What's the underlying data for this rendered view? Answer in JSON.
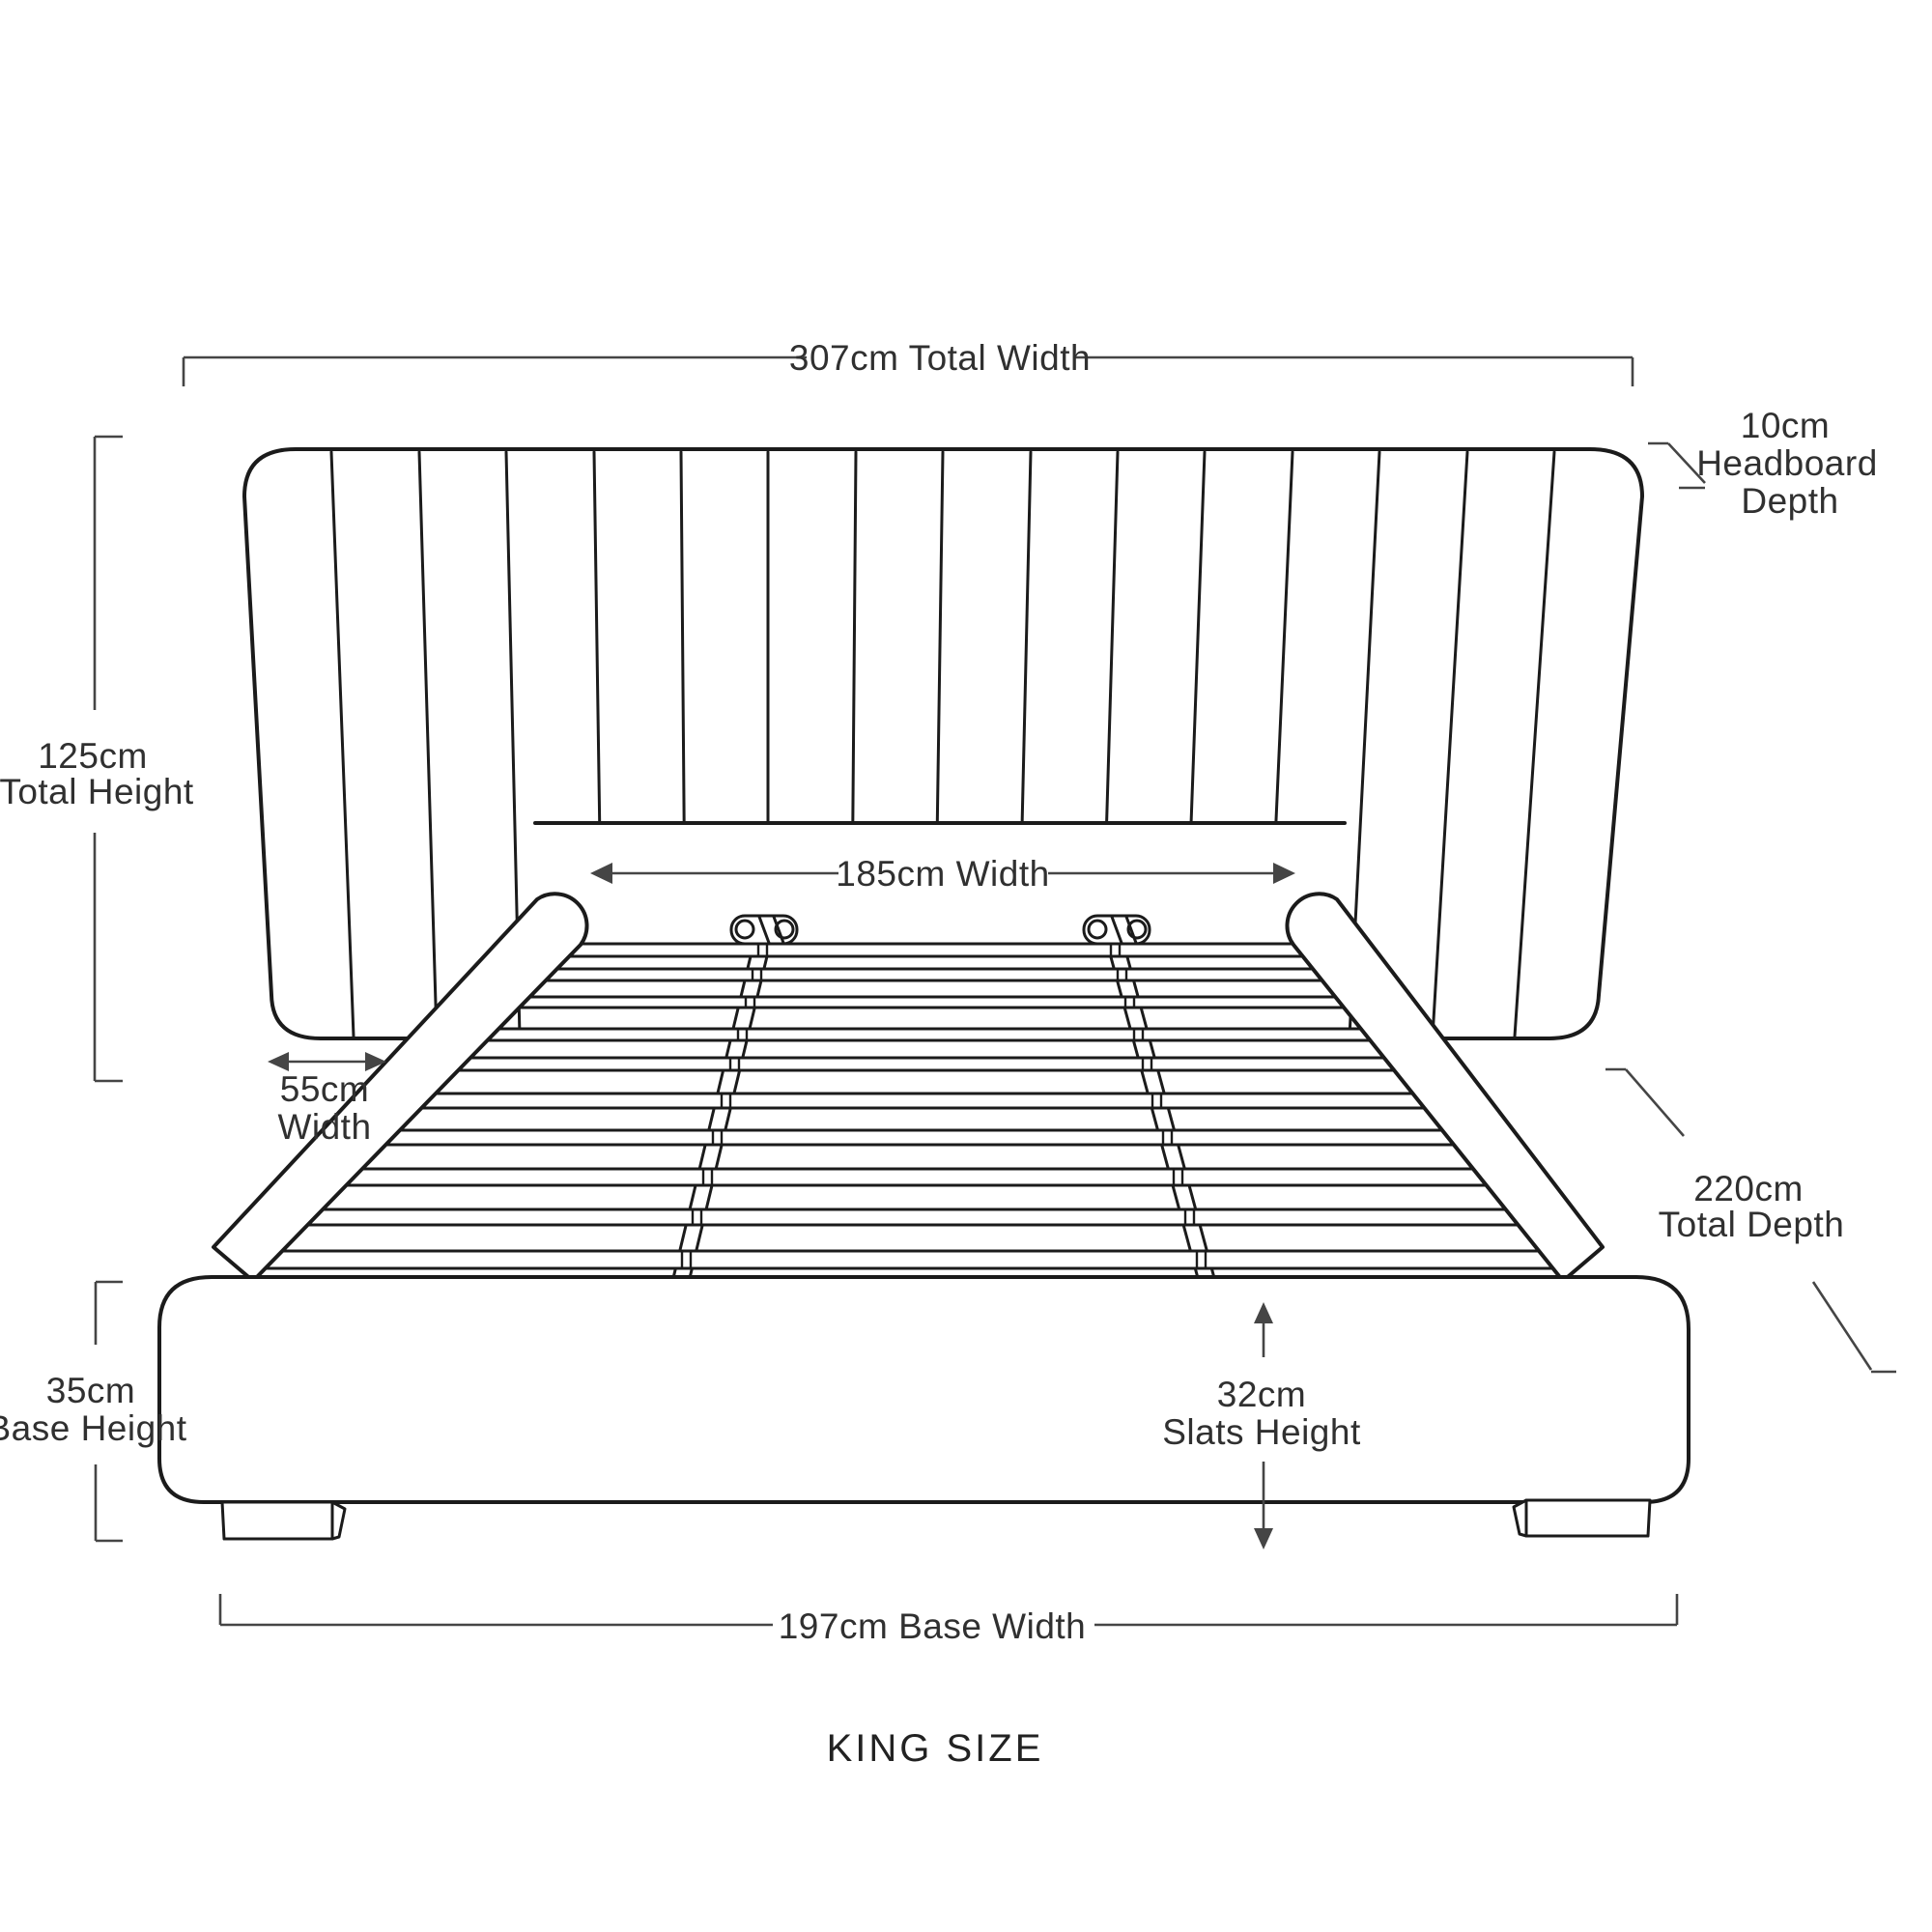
{
  "title": "KING SIZE",
  "colors": {
    "line": "#1b1b1b",
    "dimension": "#454545",
    "text": "#303030",
    "background": "#ffffff"
  },
  "dimensions": {
    "total_width": "307cm Total Width",
    "headboard_depth": [
      "10cm",
      "Headboard",
      "Depth"
    ],
    "total_height": [
      "125cm",
      "Total Height"
    ],
    "inner_width": "185cm Width",
    "wing_width": [
      "55cm",
      "Width"
    ],
    "total_depth": [
      "220cm",
      "Total Depth"
    ],
    "base_height": [
      "35cm",
      "Base Height"
    ],
    "slats_height": [
      "32cm",
      "Slats Height"
    ],
    "base_width": "197cm Base Width"
  }
}
